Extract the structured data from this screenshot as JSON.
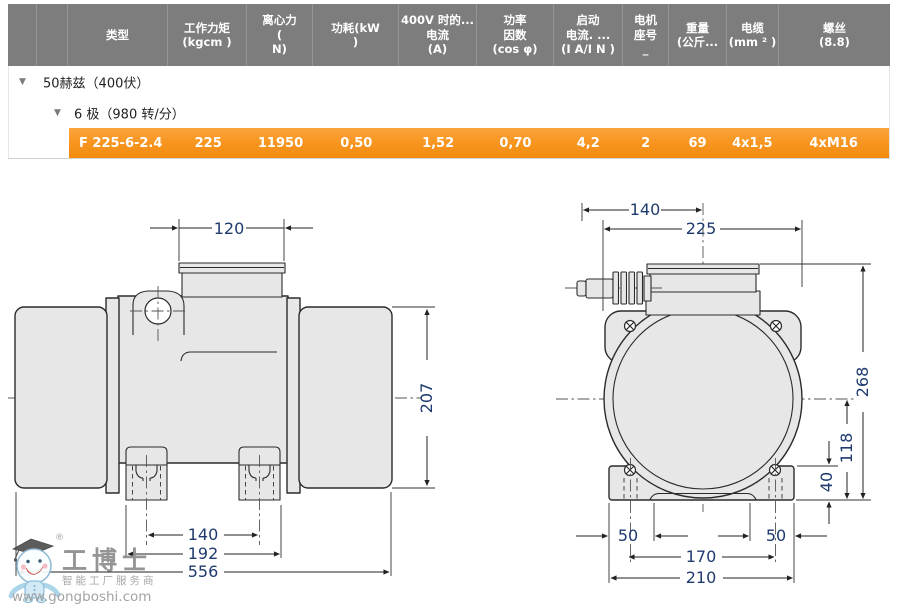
{
  "icons": {
    "collapse": "▼"
  },
  "table": {
    "headers": [
      "",
      "",
      "类型",
      "工作力矩\n(kgcm )",
      "离心力\n(\nN)",
      "功耗(kW\n)",
      "400V 时的...\n电流\n(A)",
      "功率\n因数\n(cos φ)",
      "启动\n电流. ...\n(I A/I N )",
      "电机\n座号\n_",
      "重量\n(公斤...",
      "电缆\n(mm ² )",
      "螺丝\n(8.8)"
    ],
    "rows": {
      "group": "50赫兹（400伏）",
      "subgroup": "6 极（980 转/分）",
      "selected": {
        "type": "F 225-6-2.4",
        "torque": "225",
        "centrifugal_force": "11950",
        "power_kw": "0,50",
        "current_400v": "1,52",
        "cos_phi": "0,70",
        "start_current": "4,2",
        "frame": "2",
        "weight": "69",
        "cable": "4x1,5",
        "screws": "4xM16"
      }
    }
  },
  "diagram": {
    "side_view": {
      "terminal_box_width": "120",
      "body_height": "207",
      "foot_slot_spacing": "140",
      "foot_outer_width": "192",
      "total_length": "556"
    },
    "front_view": {
      "gland_to_center": "140",
      "housing_width": "225",
      "total_height": "268",
      "axis_height": "118",
      "foot_height": "40",
      "edge_left": "50",
      "edge_right": "50",
      "slot_spacing": "170",
      "base_width": "210"
    }
  },
  "watermark": {
    "registered": "®",
    "brand": "工博士",
    "tagline": "智能工厂服务商",
    "url": "www.gongboshi.com"
  }
}
